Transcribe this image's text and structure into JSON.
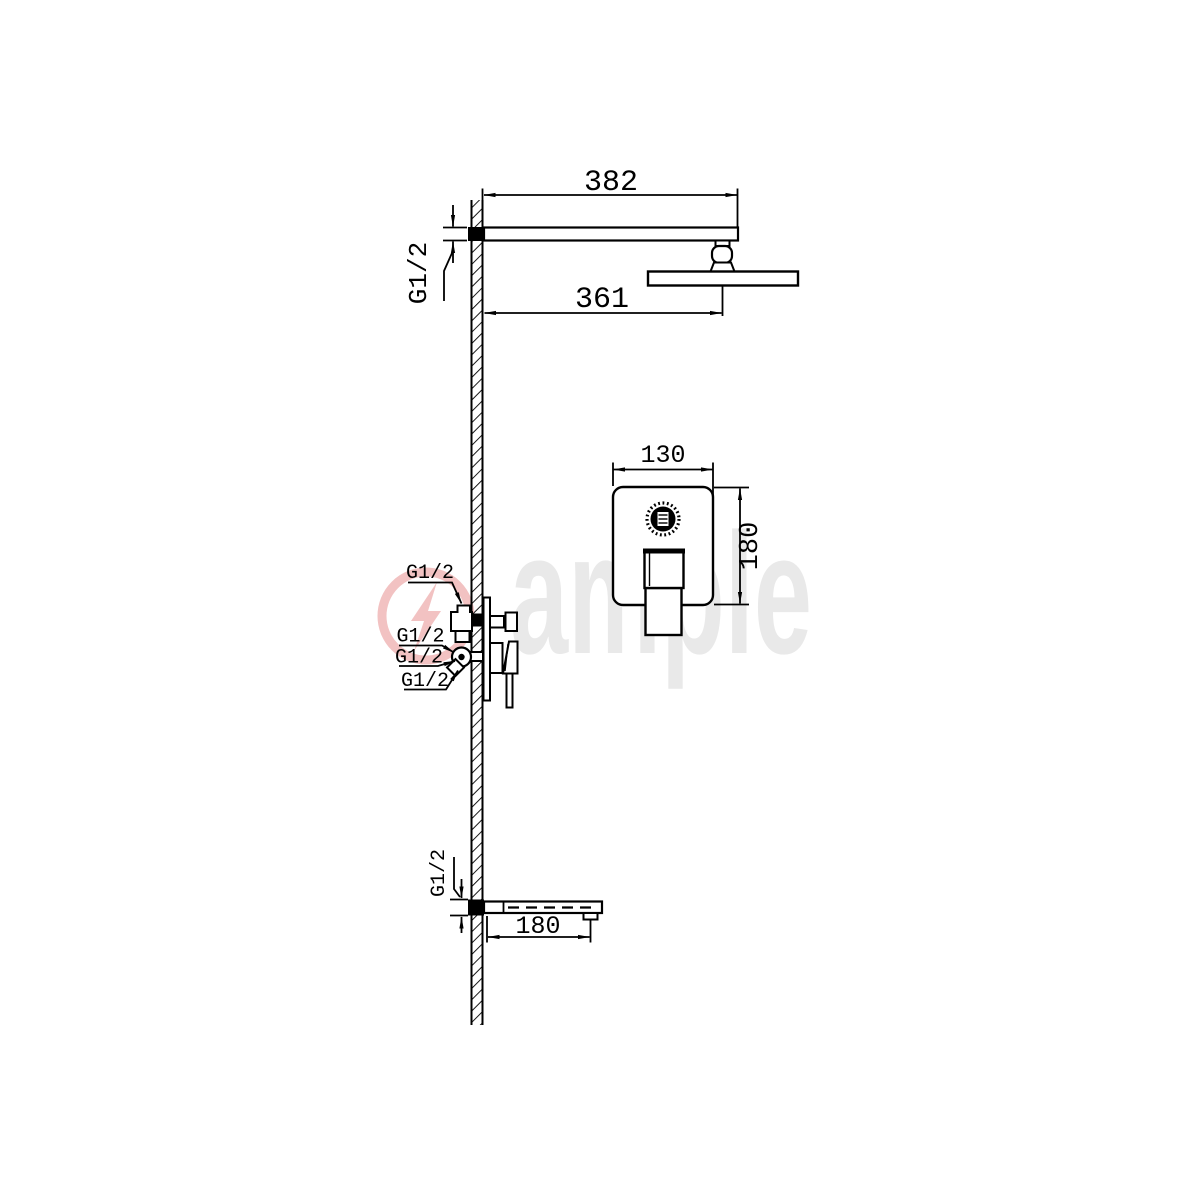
{
  "watermark": {
    "brand": "ample",
    "text_color": "#e9e9e9",
    "logo_color": "#f2c2c2"
  },
  "dims": {
    "arm_length": "382",
    "head_reach": "361",
    "panel_width": "130",
    "panel_height": "180",
    "spout_length": "180"
  },
  "threads": {
    "arm": "G1/2",
    "valve_top": "G1/2",
    "valve_mid_upper": "G1/2",
    "valve_mid_lower": "G1/2",
    "valve_bottom": "G1/2",
    "spout": "G1/2"
  }
}
